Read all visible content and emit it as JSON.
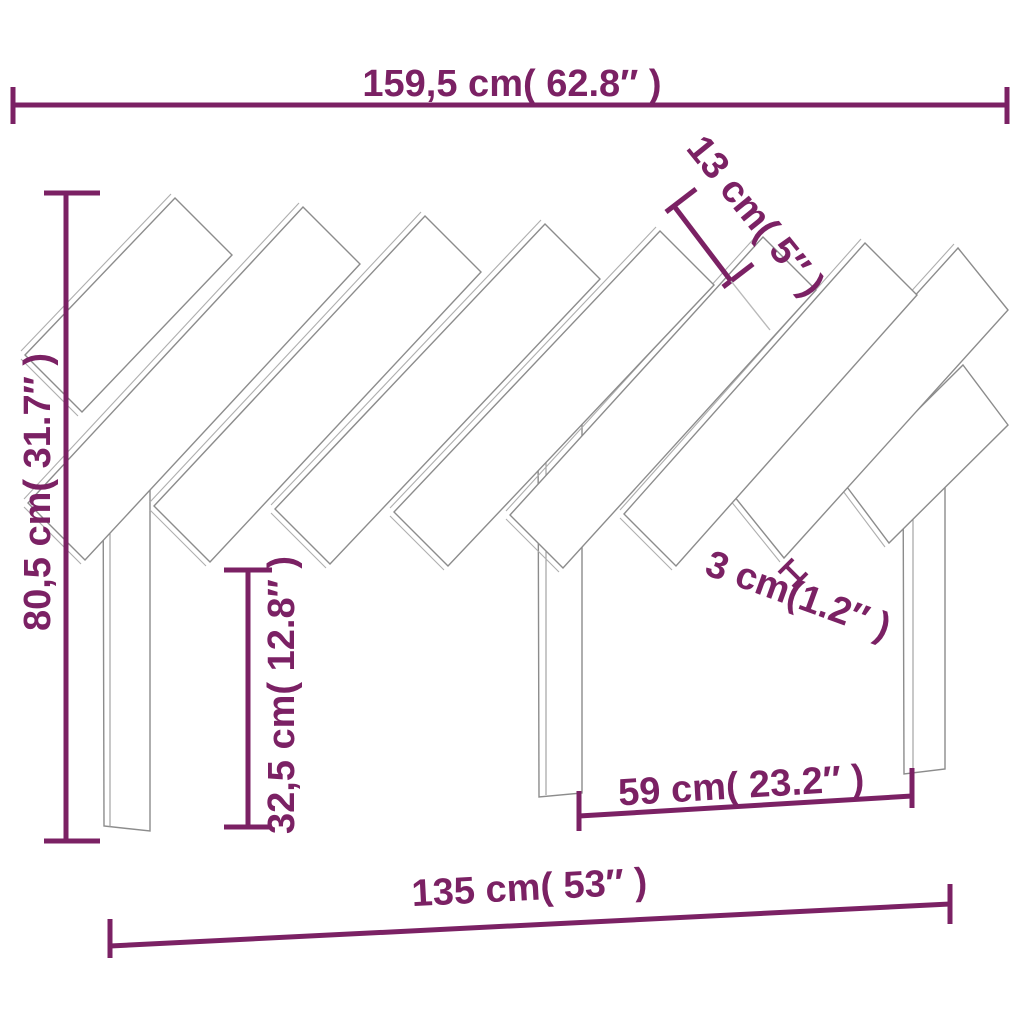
{
  "figure": {
    "colors": {
      "accent": "#7b2164",
      "drawing_outline": "#8c8c8c",
      "background": "#ffffff"
    }
  },
  "dimensions": {
    "width_top": "159,5 cm( 62.8″ )",
    "slat_width": "13 cm( 5″ )",
    "height_total": "80,5 cm( 31.7″ )",
    "leg_height": "32,5 cm( 12.8″ )",
    "thickness": "3 cm(1.2″ )",
    "leg_gap": "59 cm( 23.2″ )",
    "width_bottom": "135 cm( 53″ )"
  }
}
